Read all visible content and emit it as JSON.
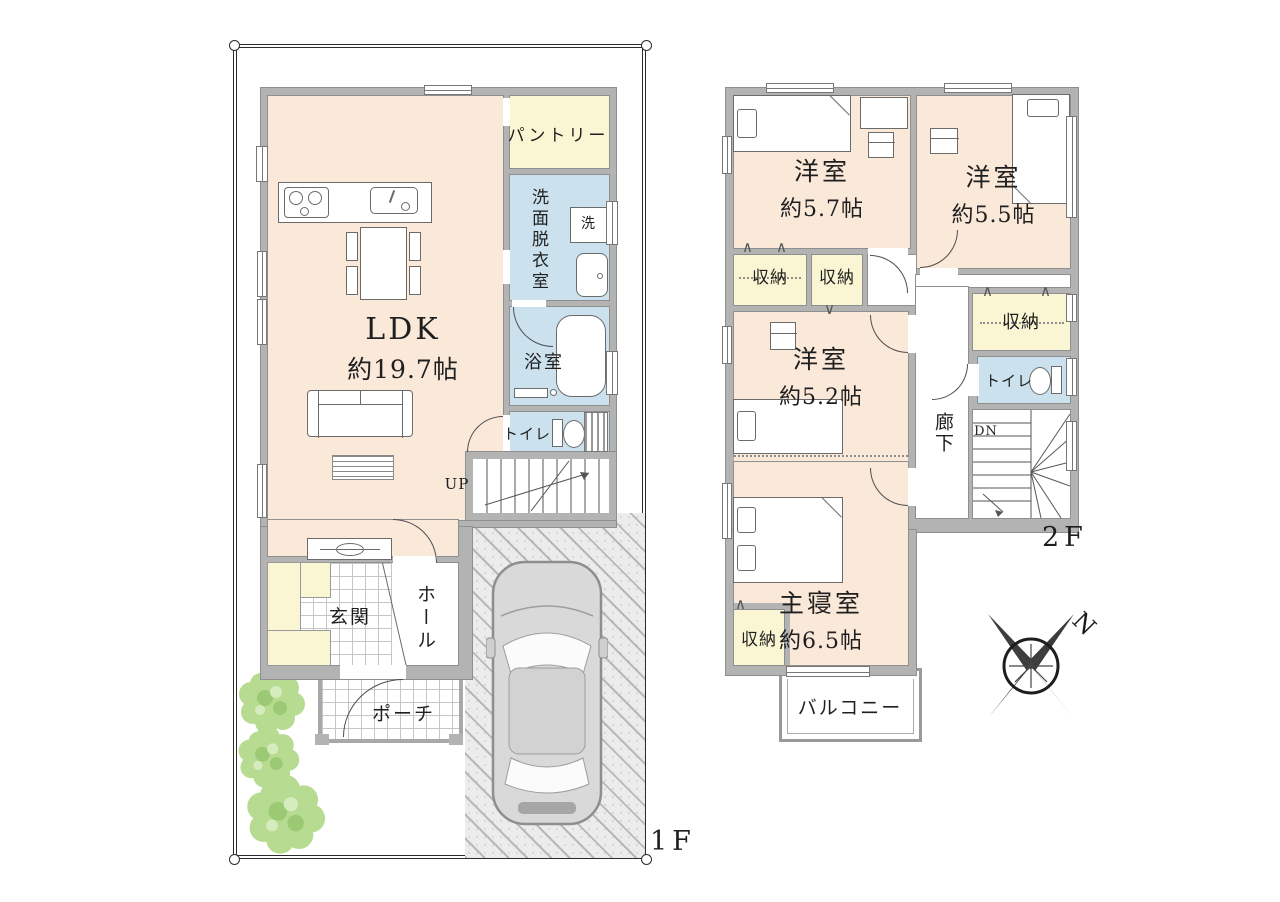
{
  "floor1": {
    "label": "1F",
    "ldk": {
      "name": "LDK",
      "size": "約19.7帖"
    },
    "pantry": "パントリー",
    "washroom": "洗面脱衣室",
    "washer": "洗",
    "bath": "浴室",
    "toilet": "トイレ",
    "stairs": "UP",
    "entrance": "玄関",
    "hall": "ホール",
    "porch": "ポーチ"
  },
  "floor2": {
    "label": "2F",
    "room_a": {
      "name": "洋室",
      "size": "約5.7帖"
    },
    "room_b": {
      "name": "洋室",
      "size": "約5.5帖"
    },
    "room_c": {
      "name": "洋室",
      "size": "約5.2帖"
    },
    "master": {
      "name": "主寝室",
      "size": "約6.5帖"
    },
    "storage": "収納",
    "toilet": "トイレ",
    "corridor": "廊下",
    "stairs": "DN",
    "balcony": "バルコニー"
  },
  "compass": {
    "north": "N"
  },
  "colors": {
    "room": "#fae8d9",
    "wet": "#cbe2ee",
    "store": "#faf6d3",
    "wall": "#b3b3b3",
    "line": "#4e4e4e"
  }
}
